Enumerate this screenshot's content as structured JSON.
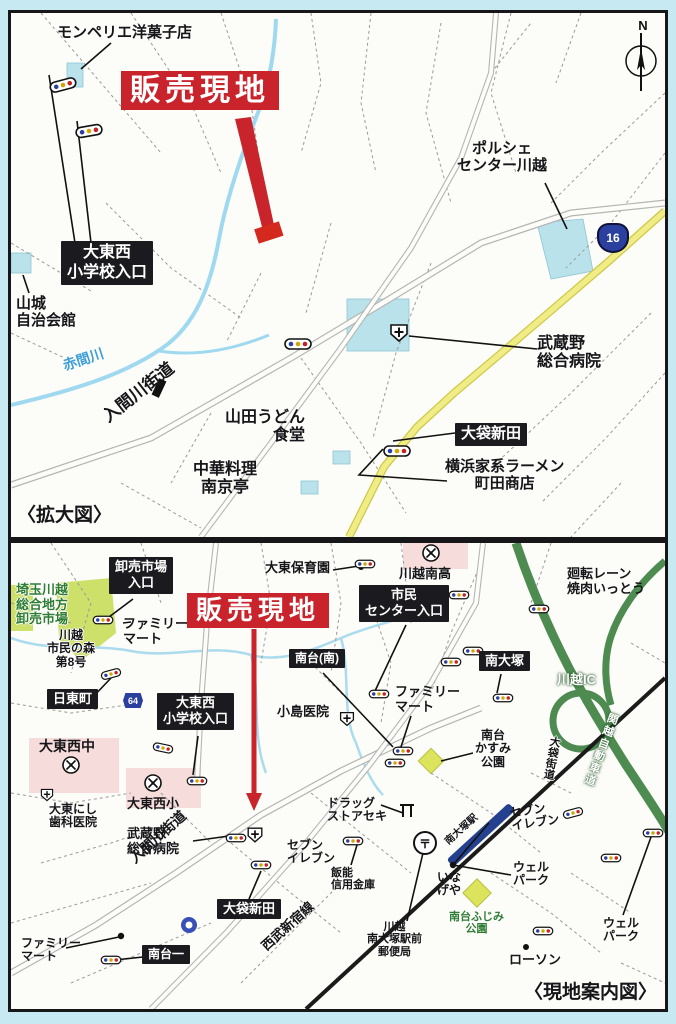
{
  "page": {
    "background_color": "#c6e9f2",
    "type": "real-estate flyer access maps"
  },
  "colors": {
    "site_red": "#c9232b",
    "badge_black": "#1b1b1f",
    "route_yellow": "#f0ec86",
    "expressway_green": "#4d8b51",
    "river_blue": "#9fd9ef",
    "station_blue": "#24418f",
    "park_lime": "#cde06a",
    "building_cyan": "#b9e2ea"
  },
  "icons": {
    "post": "〒"
  },
  "top_map": {
    "caption": "〈拡大図〉",
    "compass_label": "N",
    "route_shield_number": "16",
    "labels": [
      {
        "n": "montpellier-label",
        "t": "モンペリエ洋菓子店",
        "x": 46,
        "y": 12,
        "fs": 15
      },
      {
        "n": "sales-site-label",
        "t": "販売現地",
        "x": 110,
        "y": 58,
        "fs": 30,
        "cls": "red-badge"
      },
      {
        "n": "porsche-center-label",
        "t": "ポルシェ\nセンター川越",
        "x": 446,
        "y": 128,
        "fs": 15,
        "cls": "center"
      },
      {
        "n": "daitonishi-school-entrance-label",
        "t": "大東西\n小学校入口",
        "x": 50,
        "y": 228,
        "fs": 16,
        "cls": "badge center"
      },
      {
        "n": "yamashiro-hall-label",
        "t": "山城\n自治会館",
        "x": 5,
        "y": 283,
        "fs": 15
      },
      {
        "n": "akama-river-label",
        "t": "赤間川",
        "x": 50,
        "y": 346,
        "fs": 14,
        "cls": "blue",
        "rot": -18
      },
      {
        "n": "irumagawa-road-label",
        "t": "入間川街道",
        "x": 88,
        "y": 398,
        "fs": 17,
        "rot": -38
      },
      {
        "n": "yamada-udon-label",
        "t": "山田うどん\n食堂",
        "x": 214,
        "y": 396,
        "fs": 16,
        "cls": "right"
      },
      {
        "n": "nankintei-label",
        "t": "中華料理\n南京亭",
        "x": 182,
        "y": 448,
        "fs": 16,
        "cls": "center"
      },
      {
        "n": "obukuro-shinden-label",
        "t": "大袋新田",
        "x": 444,
        "y": 410,
        "fs": 15,
        "cls": "badge"
      },
      {
        "n": "yokohama-ramen-label",
        "t": "横浜家系ラーメン\n町田商店",
        "x": 434,
        "y": 446,
        "fs": 15,
        "cls": "center"
      },
      {
        "n": "musashino-hospital-label",
        "t": "武蔵野\n総合病院",
        "x": 526,
        "y": 322,
        "fs": 16
      }
    ]
  },
  "bottom_map": {
    "caption": "〈現地案内図〉",
    "route_badge_number": "64",
    "labels": [
      {
        "n": "wholesale-entrance-label",
        "t": "卸売市場\n入口",
        "x": 98,
        "y": 14,
        "fs": 13,
        "cls": "badge center"
      },
      {
        "n": "saitama-market-label",
        "t": "埼玉川越\n総合地方\n卸売市場",
        "x": 5,
        "y": 40,
        "fs": 13,
        "cls": "green"
      },
      {
        "n": "shiminmori-label",
        "t": "川越\n市民の森\n第8号",
        "x": 36,
        "y": 86,
        "fs": 12,
        "cls": "center halo"
      },
      {
        "n": "familymart-north-label",
        "t": "ファミリー\nマート",
        "x": 112,
        "y": 74,
        "fs": 13
      },
      {
        "n": "nitto-cho-label",
        "t": "日東町",
        "x": 36,
        "y": 146,
        "fs": 13,
        "cls": "badge"
      },
      {
        "n": "daitonishi-entrance-label-b",
        "t": "大東西\n小学校入口",
        "x": 146,
        "y": 150,
        "fs": 13,
        "cls": "badge center"
      },
      {
        "n": "daitonishi-junior-high-label",
        "t": "大東西中",
        "x": 28,
        "y": 196,
        "fs": 14
      },
      {
        "n": "daito-dental-label",
        "t": "大東にし\n歯科医院",
        "x": 38,
        "y": 260,
        "fs": 12
      },
      {
        "n": "daitonishi-elementary-label",
        "t": "大東西小",
        "x": 116,
        "y": 254,
        "fs": 13
      },
      {
        "n": "sales-site-label-b",
        "t": "販売現地",
        "x": 176,
        "y": 50,
        "fs": 26,
        "cls": "red-badge"
      },
      {
        "n": "daito-nursery-label",
        "t": "大東保育園",
        "x": 254,
        "y": 18,
        "fs": 13
      },
      {
        "n": "kawagoe-minami-hs-label",
        "t": "川越南高",
        "x": 388,
        "y": 24,
        "fs": 13
      },
      {
        "n": "civic-center-entrance-label",
        "t": "市民\nセンター入口",
        "x": 348,
        "y": 42,
        "fs": 13,
        "cls": "badge center"
      },
      {
        "n": "minamidai-minami-label",
        "t": "南台(南)",
        "x": 278,
        "y": 106,
        "fs": 12,
        "cls": "badge"
      },
      {
        "n": "kojima-clinic-label",
        "t": "小島医院",
        "x": 266,
        "y": 162,
        "fs": 13
      },
      {
        "n": "familymart-mid-label",
        "t": "ファミリー\nマート",
        "x": 384,
        "y": 142,
        "fs": 13
      },
      {
        "n": "minami-otsuka-label",
        "t": "南大塚",
        "x": 468,
        "y": 108,
        "fs": 13,
        "cls": "badge"
      },
      {
        "n": "yakiniku-itto-label",
        "t": "廻転レーン\n焼肉いっとう",
        "x": 556,
        "y": 24,
        "fs": 13
      },
      {
        "n": "kawagoe-ic-label",
        "t": "川越IC",
        "x": 546,
        "y": 130,
        "fs": 13,
        "cls": "on-green"
      },
      {
        "n": "kanetsu-expressway-label",
        "t": "関越自動車道",
        "x": 597,
        "y": 168,
        "fs": 11,
        "cls": "on-green vertical"
      },
      {
        "n": "kasumi-park-label",
        "t": "南台\nかすみ\n公園",
        "x": 464,
        "y": 186,
        "fs": 12,
        "cls": "center"
      },
      {
        "n": "musashino-hospital-label-b",
        "t": "武蔵野\n総合病院",
        "x": 116,
        "y": 284,
        "fs": 13
      },
      {
        "n": "irumagawa-road-label-b",
        "t": "入間川街道",
        "x": 116,
        "y": 312,
        "fs": 14,
        "rot": -42
      },
      {
        "n": "obukuro-shinden-label-b",
        "t": "大袋新田",
        "x": 206,
        "y": 356,
        "fs": 13,
        "cls": "badge"
      },
      {
        "n": "seven-eleven-west-label",
        "t": "セブン\nイレブン",
        "x": 276,
        "y": 296,
        "fs": 12
      },
      {
        "n": "hanno-shinkin-label",
        "t": "飯能\n信用金庫",
        "x": 320,
        "y": 324,
        "fs": 11
      },
      {
        "n": "drugstore-seki-label",
        "t": "ドラッグ\nストアセキ",
        "x": 316,
        "y": 254,
        "fs": 12
      },
      {
        "n": "minamidai-1-label",
        "t": "南台一",
        "x": 131,
        "y": 402,
        "fs": 12,
        "cls": "badge"
      },
      {
        "n": "familymart-south-label",
        "t": "ファミリー\nマート",
        "x": 10,
        "y": 394,
        "fs": 12
      },
      {
        "n": "seibu-shinjuku-line-label",
        "t": "西武新宿線",
        "x": 248,
        "y": 400,
        "fs": 13,
        "rot": -42
      },
      {
        "n": "minami-otsuka-station-label",
        "t": "南大塚駅",
        "x": 432,
        "y": 296,
        "fs": 10,
        "rot": -42
      },
      {
        "n": "otsuka-kaido-label",
        "t": "大袋街道",
        "x": 538,
        "y": 192,
        "fs": 11,
        "cls": "vertical-dark"
      },
      {
        "n": "seven-eleven-east-label",
        "t": "セブン\nイレブン",
        "x": 498,
        "y": 264,
        "fs": 12,
        "rot": -8
      },
      {
        "n": "welpark-mid-label",
        "t": "ウェル\nパーク",
        "x": 502,
        "y": 318,
        "fs": 12
      },
      {
        "n": "inageya-label",
        "t": "いな\nげや",
        "x": 426,
        "y": 328,
        "fs": 12
      },
      {
        "n": "fujimi-park-label",
        "t": "南台ふじみ\n公園",
        "x": 438,
        "y": 368,
        "fs": 11,
        "cls": "green center"
      },
      {
        "n": "post-office-label",
        "t": "川越\n南大塚駅前\n郵便局",
        "x": 356,
        "y": 378,
        "fs": 11,
        "cls": "center"
      },
      {
        "n": "lawson-label",
        "t": "ローソン",
        "x": 498,
        "y": 410,
        "fs": 13
      },
      {
        "n": "welpark-east-label",
        "t": "ウェル\nパーク",
        "x": 592,
        "y": 374,
        "fs": 12
      }
    ]
  }
}
